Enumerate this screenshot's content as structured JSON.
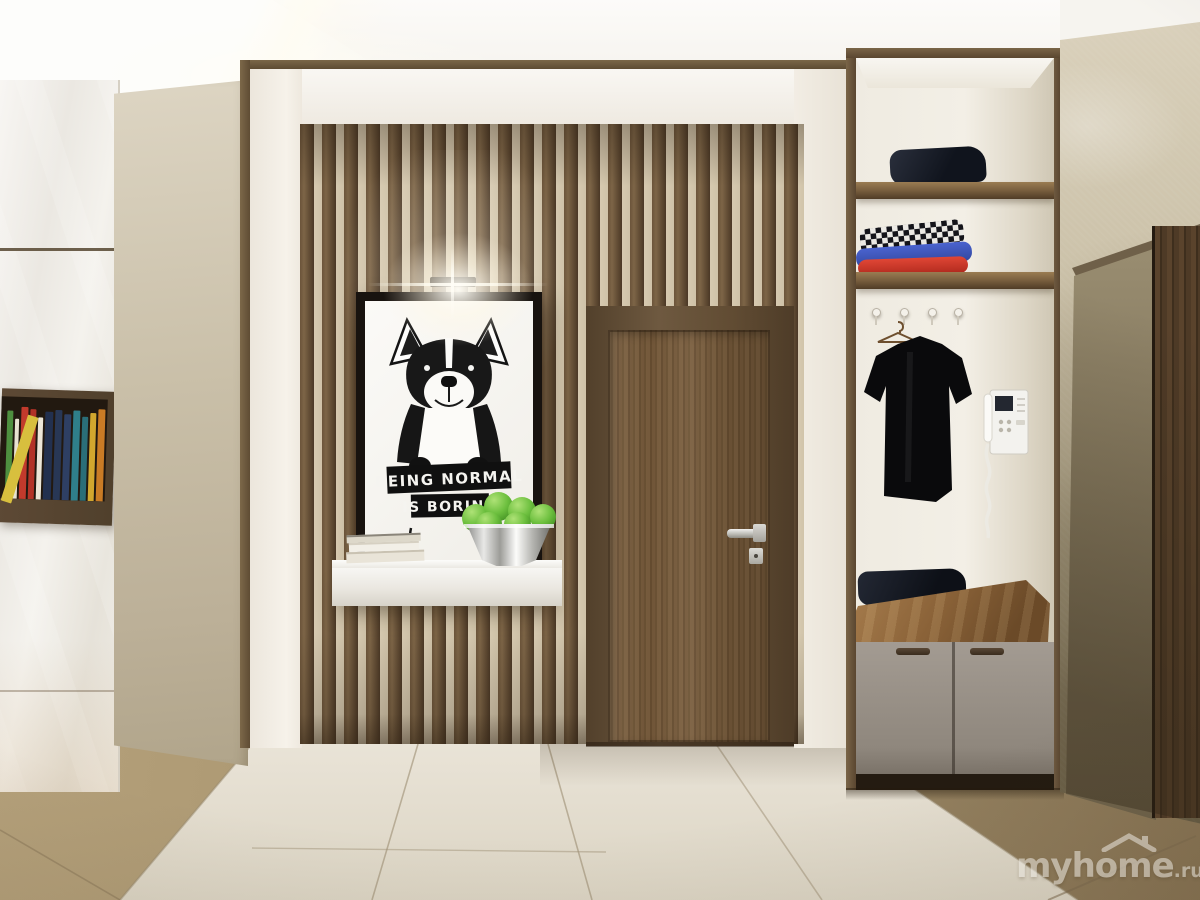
{
  "poster": {
    "sign_line1": "BEING NORMAL",
    "sign_line2": "IS BORING"
  },
  "watermark": {
    "brand": "myhome",
    "suffix": ".ru"
  },
  "palette": {
    "apple_green": "#6cbf3e",
    "slat_wood": "#55412c",
    "slat_gap": "#d6c9b0",
    "door_wood": "#7b5f3f",
    "trim_wood": "#5d4b33",
    "column_beige": "#c9bfa8",
    "stone_wall": "#c9bfa6",
    "tile_tan": "#a8946e",
    "tile_white": "#e7e1d4",
    "wood_floor": "#d2ab6a",
    "poster_ink": "#101010",
    "cushion_leather": "#8a6238",
    "cabinet_gray": "#8f877d",
    "watermark_white": "#f8f5ee"
  }
}
